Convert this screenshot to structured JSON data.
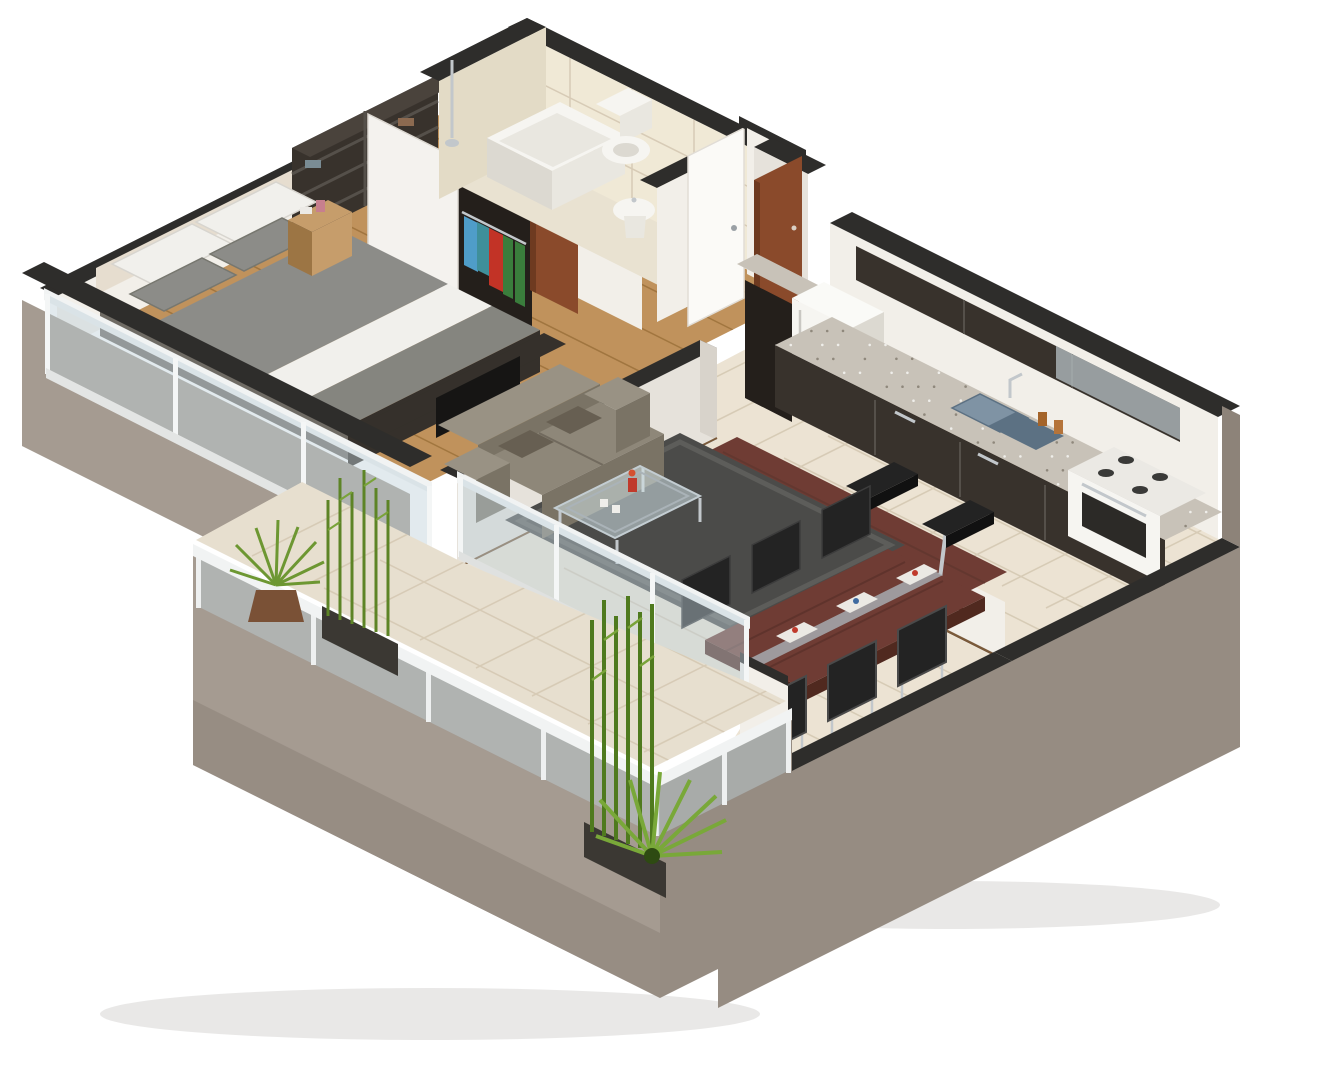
{
  "scene": {
    "title": "3D isometric cutaway floor plan of a one-bedroom apartment",
    "type": "architectural-3d-render",
    "view": "isometric dollhouse cutaway",
    "rooms": [
      {
        "name": "bedroom",
        "floor": "light-wood",
        "furniture": [
          "double-bed",
          "cream-pillows",
          "gray-pillows",
          "gray-duvet-with-white-band",
          "nightstand",
          "tv-bench",
          "glass-sliding-window"
        ]
      },
      {
        "name": "dressing-area",
        "floor": "light-wood",
        "furniture": [
          "espresso-wardrobe-shelves",
          "white-sliding-panel",
          "closet-rod",
          "hanging-clothes-blue-red-green",
          "wood-door"
        ]
      },
      {
        "name": "bathroom",
        "floor": "ceramic-tile",
        "furniture": [
          "bathtub",
          "toilet",
          "bidet",
          "shower-fixture",
          "white-door"
        ]
      },
      {
        "name": "entry",
        "floor": "ceramic-tile",
        "furniture": [
          "open-wood-door"
        ]
      },
      {
        "name": "kitchen",
        "floor": "ceramic-tile",
        "furniture": [
          "refrigerator",
          "tall-cabinet",
          "upper-cabinets",
          "granite-countertop",
          "double-steel-sink",
          "gas-stove-with-oven",
          "base-cabinets",
          "breakfast-bar",
          "bar-stool",
          "bar-stool"
        ]
      },
      {
        "name": "living-room",
        "floor": "ceramic-tile",
        "furniture": [
          "two-seat-sofa",
          "throw-cushions",
          "dark-area-rug",
          "glass-coffee-table",
          "red-vase",
          "candles",
          "glass-wall-to-balcony"
        ]
      },
      {
        "name": "dining-area",
        "floor": "ceramic-tile",
        "furniture": [
          "dark-wood-dining-table",
          "chrome-runner",
          "place-settings",
          "black-chair",
          "black-chair",
          "black-chair",
          "black-chair",
          "black-chair",
          "black-chair"
        ]
      },
      {
        "name": "balcony",
        "floor": "tile",
        "furniture": [
          "glass-railing-white-rail",
          "potted-palm",
          "bamboo-planter",
          "corner-bamboo-planter",
          "fan-palm"
        ]
      }
    ],
    "palette": {
      "bg": "#ffffff",
      "wallTop": "#2e2d2b",
      "wallWhite": "#f2efe9",
      "wallWhiteShade": "#e6e2db",
      "wallCap": "#d8d3cb",
      "ext1": "#a59b91",
      "ext2": "#968c82",
      "ext3": "#877d73",
      "extCap": "#8d8379",
      "wood": "#c0925c",
      "woodLine": "#a1763f",
      "tile": "#ece3d3",
      "grout": "#d7cbb6",
      "balcTile": "#e7dfcf",
      "bathWallTile": "#f0e9d6",
      "bathWallTileShade": "#e3dbc6",
      "bathFloor": "#e9e2d1",
      "fixture": "#f6f5f1",
      "fixtureShade": "#e9e7e0",
      "fixtureDark": "#dcd9d1",
      "doorBrown": "#8a4a2b",
      "doorBrownDark": "#6e3a20",
      "espresso": "#38322c",
      "espressoDark": "#241f1b",
      "espressoTop": "#4a433c",
      "shelfLine": "#55504a",
      "granite": "#c8c2b8",
      "graniteDot": "#8f887c",
      "steel": "#7f93a4",
      "steelDark": "#5c7183",
      "chrome": "#c2c7cb",
      "railWhite": "#f1f3f3",
      "glassFill": "rgba(190,208,218,0.45)",
      "glassStroke": "#c9d4da",
      "sofa": "#8e8779",
      "sofaShade": "#7a7365",
      "sofaDark": "#675f52",
      "sofaArm": "#999284",
      "rug": "#4b4b49",
      "rugLight": "#5d5d5a",
      "tableWood": "#6f3c34",
      "tableWoodDark": "#50291f",
      "chairBlack": "#232323",
      "chairEdge": "#3c3c3c",
      "bedGray": "#8c8c88",
      "bedGrayDark": "#85857f",
      "bedWhite": "#f1f0ec",
      "bedSide": "#6f6b64",
      "footboard": "#35302b",
      "nightstand": "#c69d6b",
      "nightstandSide": "#9c7544",
      "plantDark": "#4f7a1e",
      "plantMid": "#5d8426",
      "plantLight": "#79a339",
      "planter": "#3b3833",
      "potBrown": "#7a5136",
      "clothesBlue": "#4f9dc9",
      "clothesTeal": "#3f8f9a",
      "clothesRed": "#c23326",
      "clothesGreen": "#3a7d3c",
      "tvBlack": "#161514",
      "ovenWin": "#2c2a27",
      "baseboard": "#7a5a3a",
      "shadow": "rgba(70,64,58,0.12)"
    }
  }
}
